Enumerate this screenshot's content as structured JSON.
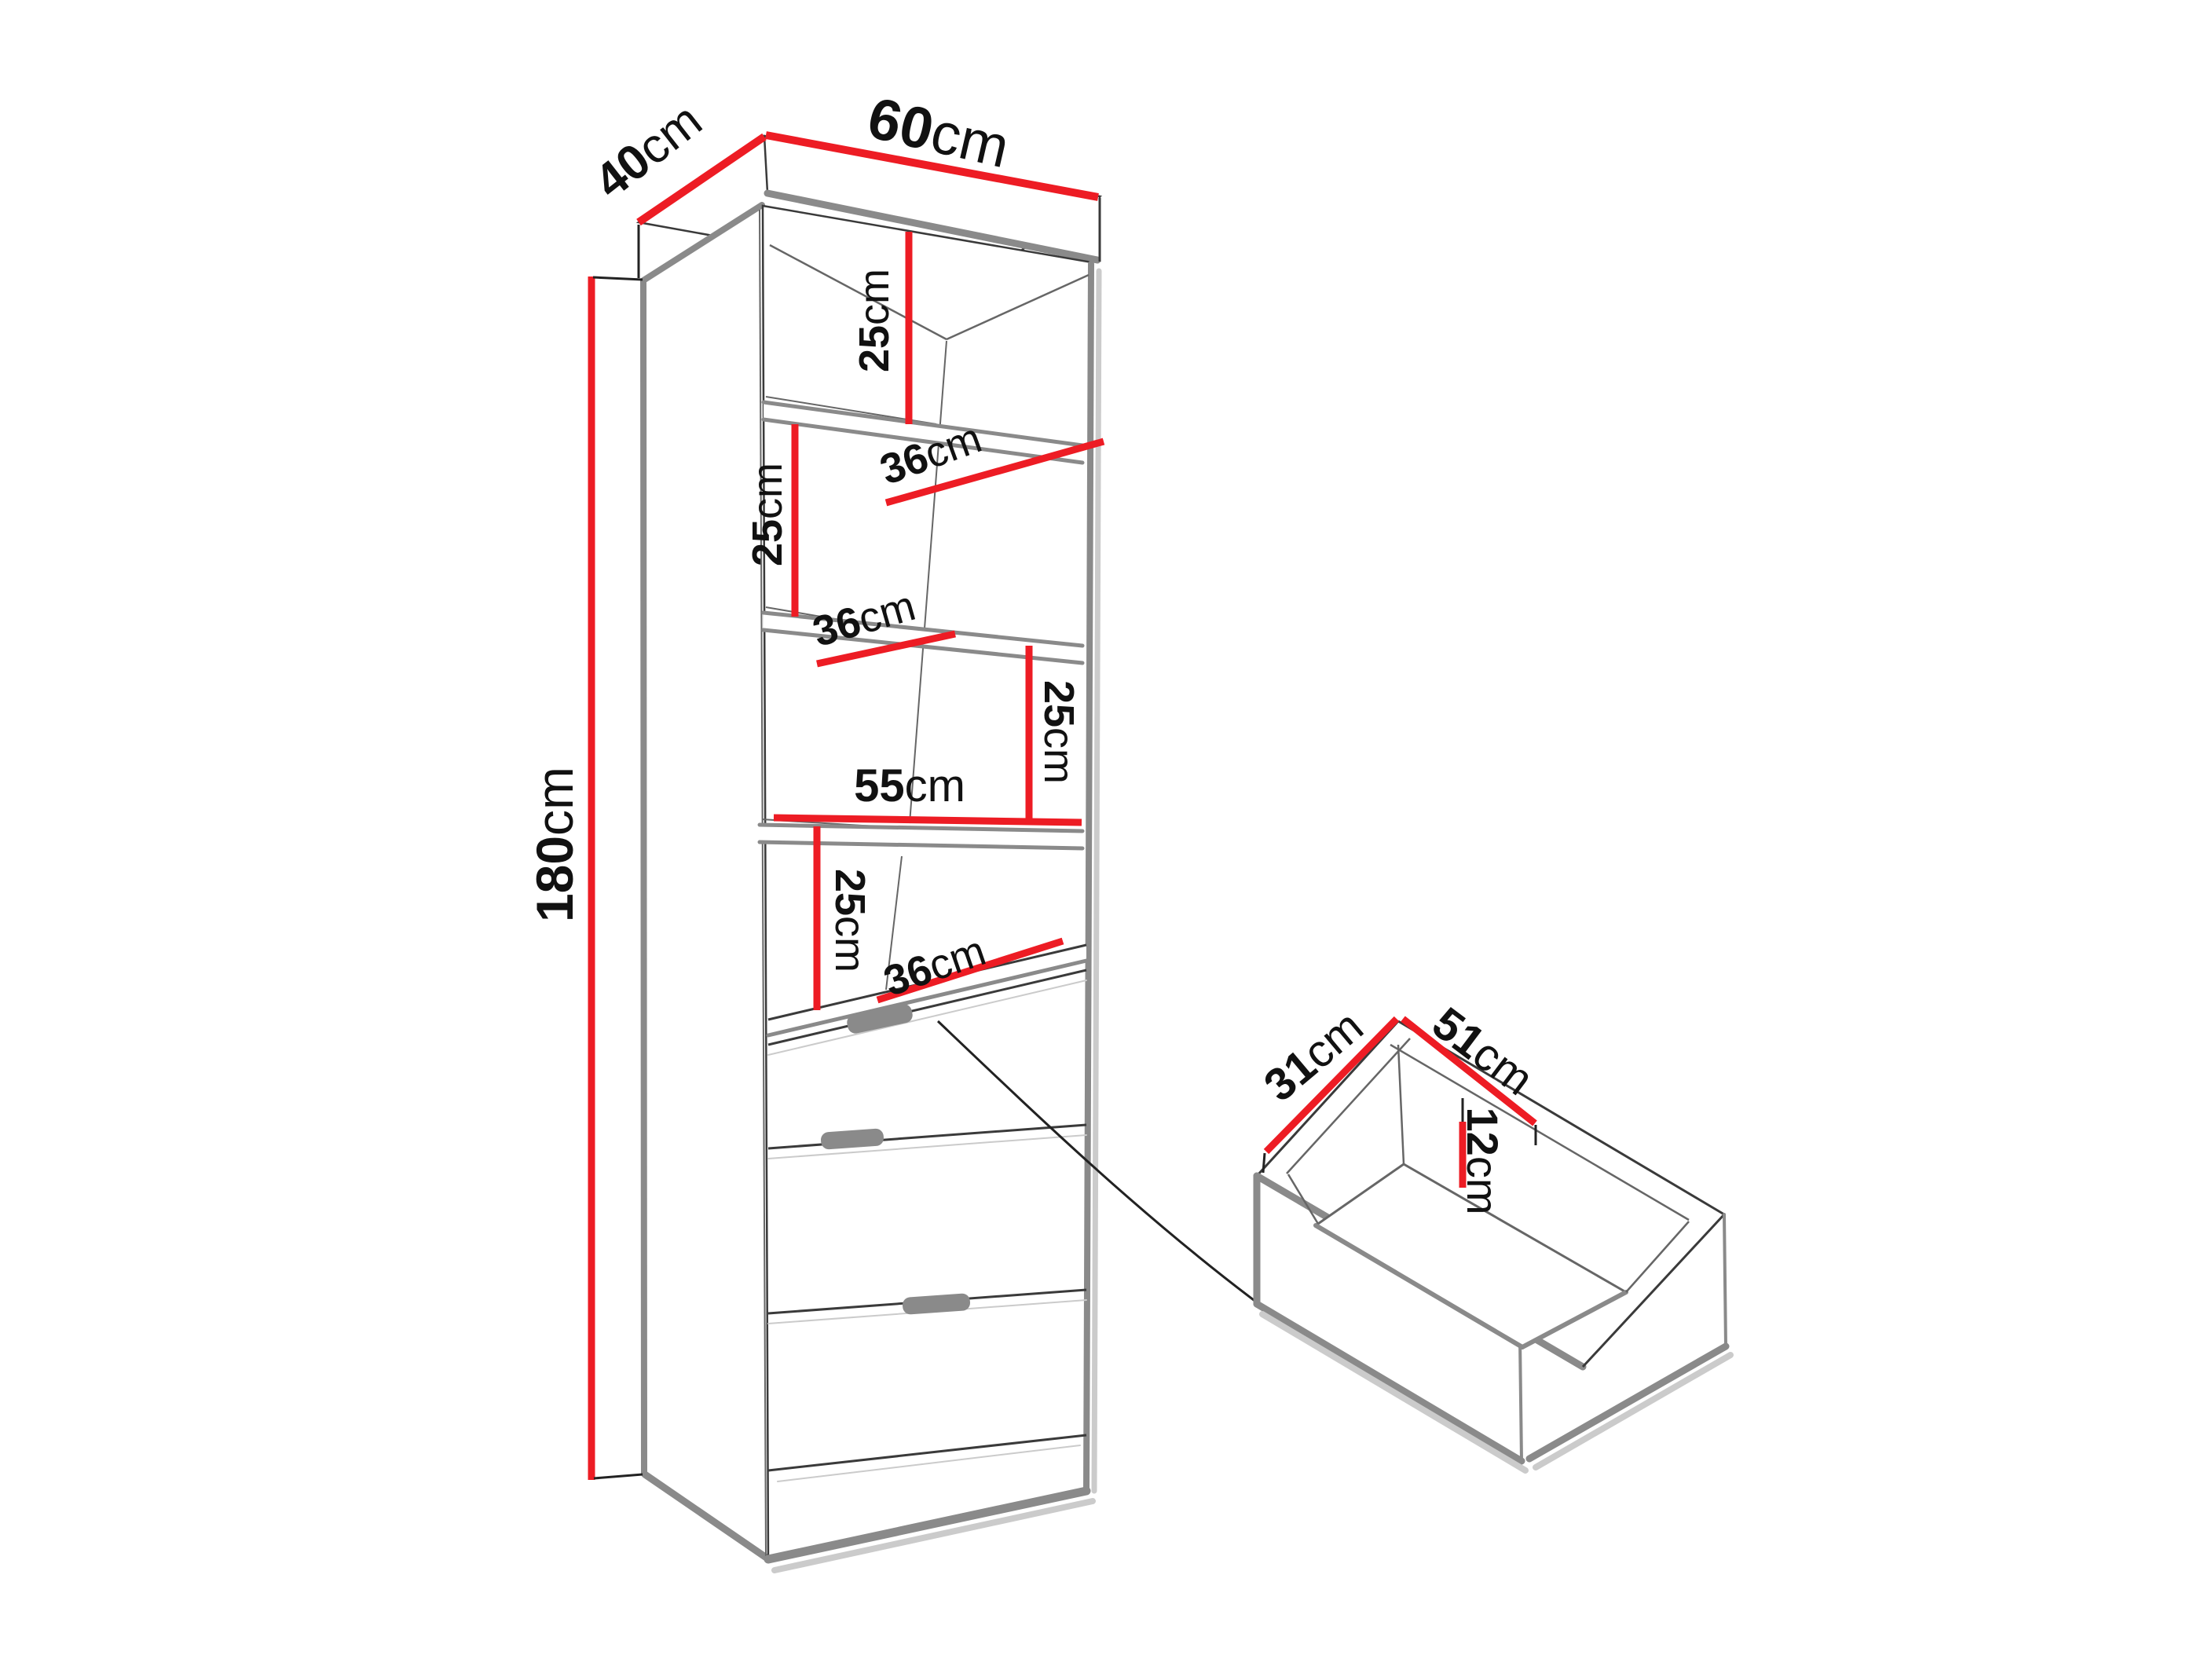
{
  "diagram": {
    "background": "#ffffff",
    "colors": {
      "dimension_red": "#ED1C24",
      "edge_gray": "#8A8A8A",
      "outline_dark": "#3A3A3A",
      "shadow_gray": "#CBCBCB",
      "label_black": "#111111"
    },
    "unit": "cm",
    "cabinet": {
      "depth": {
        "value": "40",
        "unit": "cm"
      },
      "width": {
        "value": "60",
        "unit": "cm"
      },
      "height": {
        "value": "180",
        "unit": "cm"
      },
      "interior_width": {
        "value": "55",
        "unit": "cm"
      },
      "gaps": [
        {
          "value": "25",
          "unit": "cm"
        },
        {
          "value": "25",
          "unit": "cm"
        },
        {
          "value": "25",
          "unit": "cm"
        },
        {
          "value": "25",
          "unit": "cm"
        }
      ],
      "shelves": [
        {
          "value": "36",
          "unit": "cm"
        },
        {
          "value": "36",
          "unit": "cm"
        },
        {
          "value": "36",
          "unit": "cm"
        }
      ]
    },
    "drawer": {
      "depth": {
        "value": "31",
        "unit": "cm"
      },
      "width": {
        "value": "51",
        "unit": "cm"
      },
      "inner_height": {
        "value": "12",
        "unit": "cm"
      }
    }
  }
}
